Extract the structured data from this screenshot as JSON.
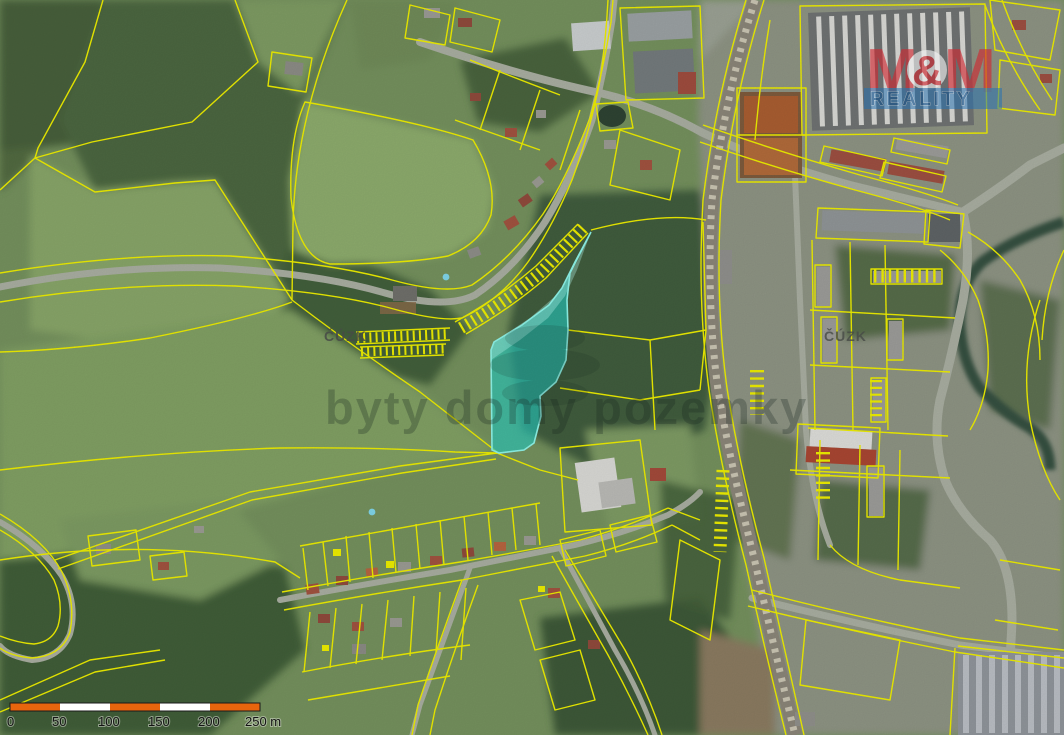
{
  "map": {
    "attribution": "ČÚZK",
    "watermark": "byty domy pozemky",
    "logo": {
      "m1": "M",
      "amp": "&",
      "m2": "M",
      "line2": "REALITY"
    },
    "scalebar": {
      "labels": [
        "0",
        "50",
        "100",
        "150",
        "200",
        "250 m"
      ]
    },
    "colors": {
      "parcel_line": "#ecec00",
      "highlight_fill": "#23cdc3",
      "highlight_stroke": "#8df2e6",
      "scalebar_orange": "#e8650d",
      "logo_red": "#d22730",
      "logo_blue": "#2472b4",
      "reality_text": "#0f5291",
      "watermark_text": "#16241f",
      "attribution_text": "#474b47"
    }
  }
}
